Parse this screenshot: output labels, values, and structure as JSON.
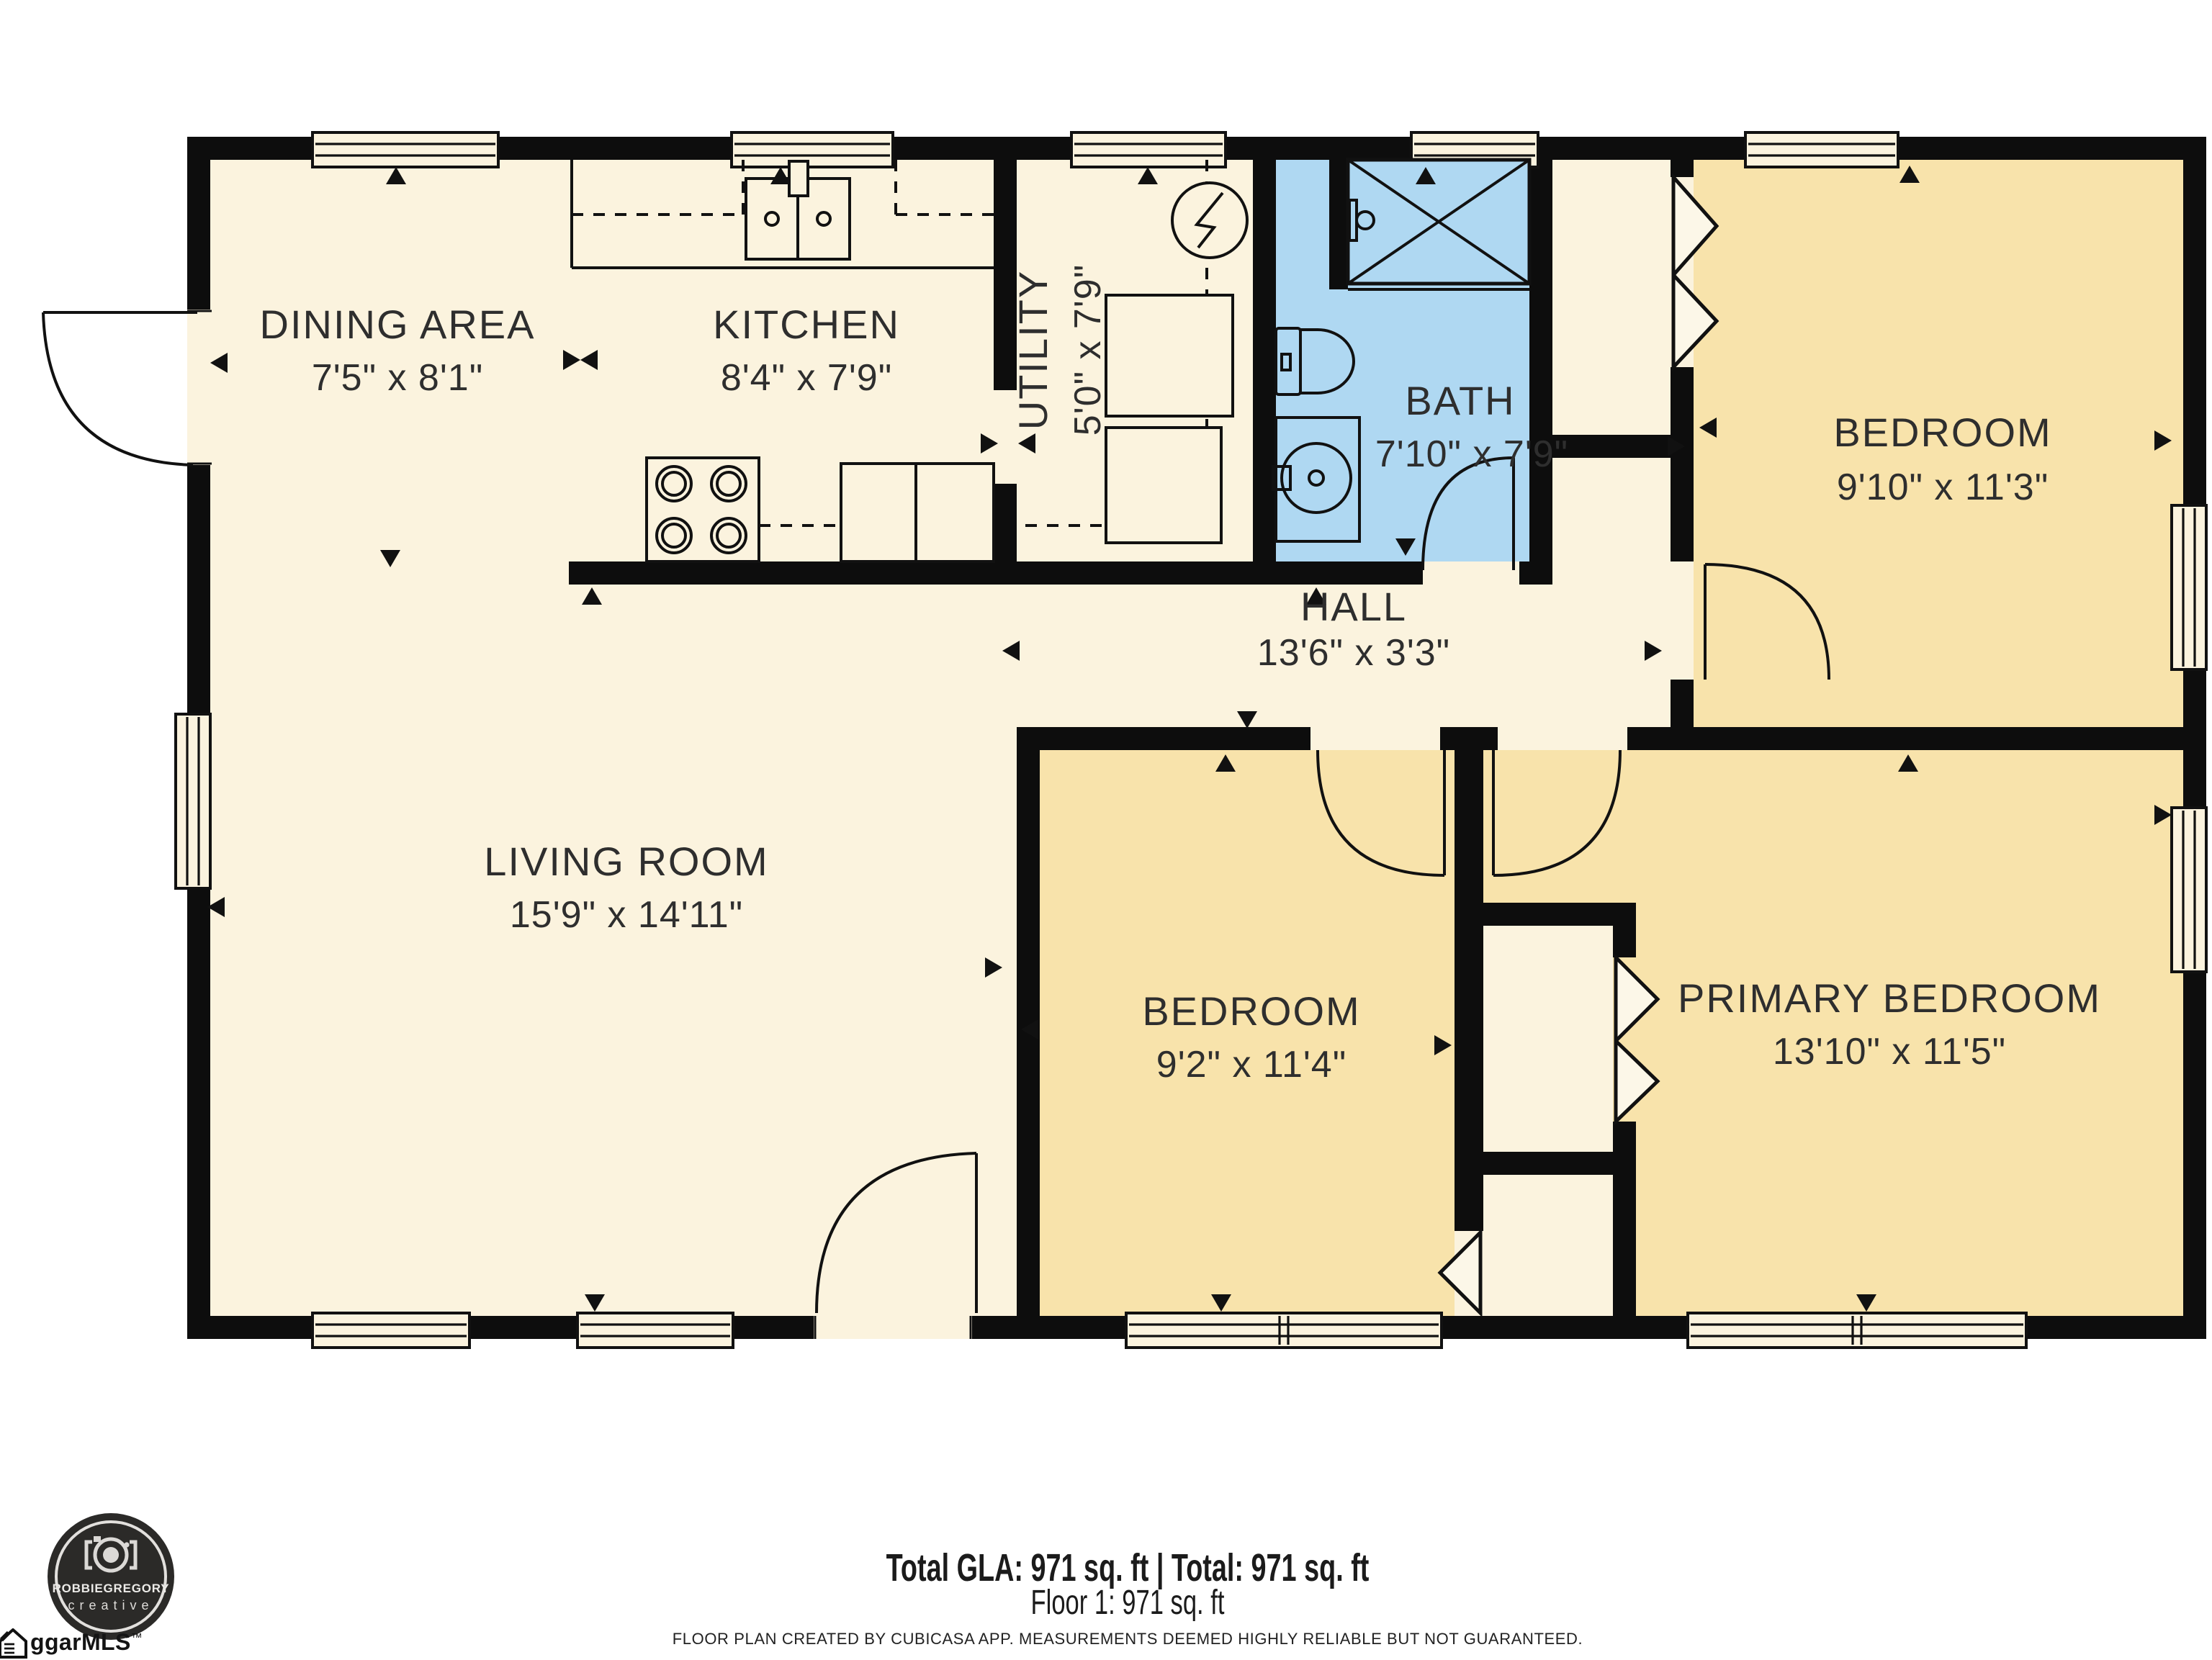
{
  "rooms": [
    {
      "id": "dining",
      "name": "DINING AREA",
      "dims": "7'5\" x 8'1\""
    },
    {
      "id": "kitchen",
      "name": "KITCHEN",
      "dims": "8'4\" x 7'9\""
    },
    {
      "id": "utility",
      "name": "UTILITY",
      "dims": "5'0\" x 7'9\""
    },
    {
      "id": "bath",
      "name": "BATH",
      "dims": "7'10\" x 7'9\""
    },
    {
      "id": "bedroom-top",
      "name": "BEDROOM",
      "dims": "9'10\" x 11'3\""
    },
    {
      "id": "hall",
      "name": "HALL",
      "dims": "13'6\" x 3'3\""
    },
    {
      "id": "living",
      "name": "LIVING ROOM",
      "dims": "15'9\" x 14'11\""
    },
    {
      "id": "bedroom-mid",
      "name": "BEDROOM",
      "dims": "9'2\" x 11'4\""
    },
    {
      "id": "primary",
      "name": "PRIMARY BEDROOM",
      "dims": "13'10\" x 11'5\""
    }
  ],
  "footer": {
    "total_line": "Total GLA: 971 sq. ft | Total: 971 sq. ft",
    "floor_line": "Floor 1: 971 sq. ft",
    "disclaimer": "FLOOR PLAN CREATED BY CUBICASA APP. MEASUREMENTS DEEMED HIGHLY RELIABLE BUT NOT GUARANTEED."
  },
  "logo": {
    "brand": "ROBBIEGREGORY",
    "tagline": "creative"
  },
  "watermark": {
    "text": "ggarMLS",
    "tm": "™"
  },
  "colors": {
    "floor": "#FBF3DE",
    "bedroom": "#F8E3AB",
    "bath": "#AFD8F2",
    "wall": "#0D0D0D",
    "text": "#2E2E2E",
    "logo_bg": "#2B2A28"
  }
}
